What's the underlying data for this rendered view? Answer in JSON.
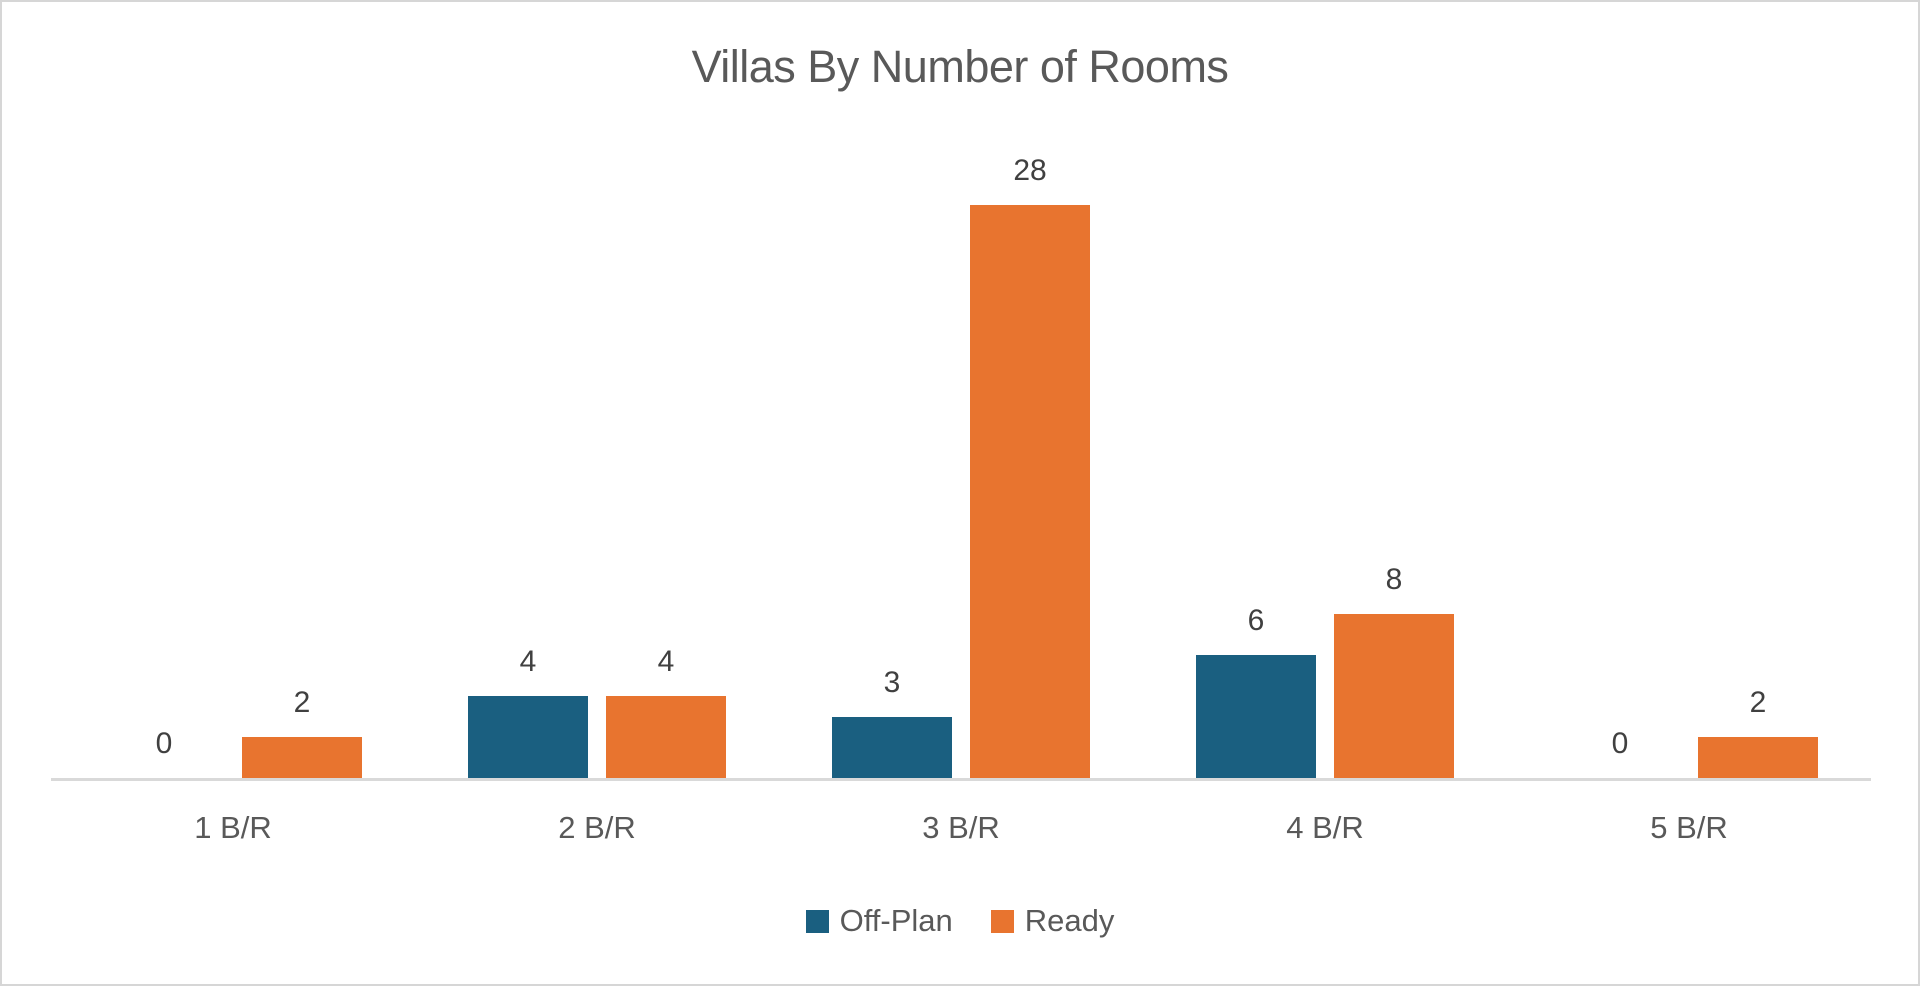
{
  "chart_data": {
    "type": "bar",
    "title": "Villas By Number of Rooms",
    "categories": [
      "1 B/R",
      "2 B/R",
      "3 B/R",
      "4 B/R",
      "5 B/R"
    ],
    "series": [
      {
        "name": "Off-Plan",
        "color": "#1A5F80",
        "values": [
          0,
          4,
          3,
          6,
          0
        ]
      },
      {
        "name": "Ready",
        "color": "#E8742F",
        "values": [
          2,
          4,
          28,
          8,
          2
        ]
      }
    ],
    "xlabel": "",
    "ylabel": "",
    "ylim": [
      0,
      28
    ],
    "grid": false,
    "data_labels": true,
    "legend_position": "bottom",
    "axis_line_color": "#D9D9D9",
    "frame_border_color": "#D6D6D6",
    "title_color": "#595959",
    "data_label_color": "#404040"
  }
}
